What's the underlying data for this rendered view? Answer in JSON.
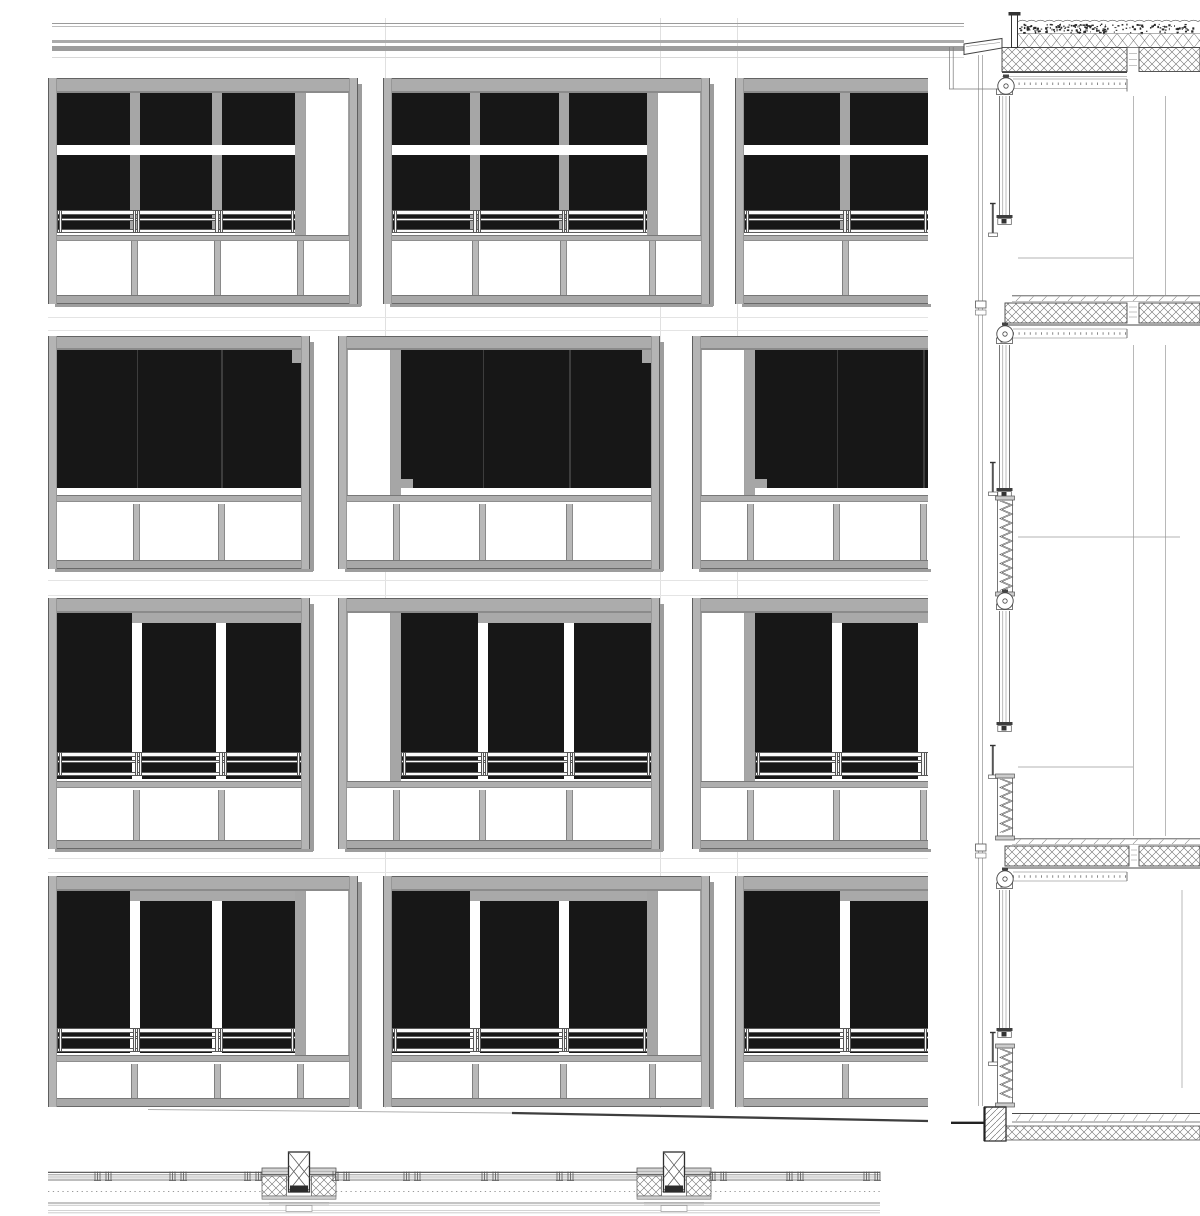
{
  "drawing": {
    "panels": {
      "elevation": "facade-elevation",
      "section": "vertical-wall-section",
      "plan": "horizontal-plan-strip"
    }
  },
  "colors": {
    "dark_glass": "#171717",
    "frame": "#acacac",
    "frame_edge": "#636363",
    "frame_light": "#b4b4b4",
    "mullion": "#a6a6a6",
    "lower_mullion": "#b8b8b8",
    "shadow": "#9d9d9d",
    "line": "#444444",
    "line_mid": "#777777",
    "line_faint": "#e0e0e0",
    "white": "#ffffff"
  },
  "facade": {
    "left": 48,
    "right": 928,
    "frame_w": 9,
    "glass_mullion_w": 10,
    "lower_mullion_w": 7,
    "side_pane_w": 44,
    "side_mullion_w": 10,
    "roof_lines": [
      {
        "y": 22.5,
        "h": 1.4,
        "color": "#9a9a9a"
      },
      {
        "y": 25.6,
        "h": 1.4,
        "color": "#bcbcbc"
      },
      {
        "y": 40.0,
        "h": 2.6,
        "color": "#ababab"
      },
      {
        "y": 45.5,
        "h": 5.5,
        "color": "#9d9d9d"
      },
      {
        "y": 57.0,
        "h": 1.0,
        "color": "#d8d8d8"
      }
    ],
    "grid_line_xs": [
      385,
      660,
      737
    ],
    "floor_faint_ys": [
      317,
      330,
      580,
      595,
      858,
      872
    ],
    "ground_slope": {
      "x1": 148,
      "y1": 1109.5,
      "xm": 512,
      "ym": 1113,
      "x2": 928,
      "y2": 1121
    },
    "rows": [
      {
        "name": "row-1",
        "style": "mullioned",
        "y": 78,
        "top_h": 15,
        "glass_top": 93,
        "dark_bottom": 232,
        "transom": {
          "y": 145,
          "h": 10
        },
        "railing": {
          "y": 210,
          "h": 23
        },
        "sill": {
          "bar_y": 234.5,
          "bar_h": 6.5
        },
        "lower_top": 241,
        "lower_bottom": 295,
        "bottom_y": 295,
        "bottom_h": 9,
        "units": [
          {
            "x": 48,
            "w": 310,
            "side": "right"
          },
          {
            "x": 383,
            "w": 327,
            "side": "right"
          },
          {
            "x": 735,
            "w": 327,
            "cut": true
          }
        ]
      },
      {
        "name": "row-2",
        "style": "blinds-full",
        "y": 336,
        "top_h": 14,
        "glass_top": 350,
        "dark_bottom": 488,
        "sill": {
          "bar_y": 494.5,
          "bar_h": 7.5
        },
        "lower_top": 504,
        "lower_bottom": 560,
        "bottom_y": 560,
        "bottom_h": 9,
        "units": [
          {
            "x": 48,
            "w": 262,
            "notches": [
              "tr"
            ]
          },
          {
            "x": 338,
            "w": 322,
            "side": "left",
            "notches": [
              "tr",
              "bl"
            ]
          },
          {
            "x": 692,
            "w": 322,
            "side": "left",
            "cut": true,
            "notches": [
              "bl"
            ]
          }
        ]
      },
      {
        "name": "row-3",
        "style": "blinds-panes",
        "y": 598,
        "top_h": 15,
        "glass_top": 613,
        "dark_bottom": 779,
        "sliver_h": 10,
        "railing": {
          "y": 752,
          "h": 24
        },
        "sill": {
          "bar_y": 781,
          "bar_h": 7
        },
        "lower_top": 790,
        "lower_bottom": 840,
        "bottom_y": 840,
        "bottom_h": 9,
        "units": [
          {
            "x": 48,
            "w": 262
          },
          {
            "x": 338,
            "w": 322,
            "side": "left"
          },
          {
            "x": 692,
            "w": 322,
            "side": "left",
            "cut": true
          }
        ]
      },
      {
        "name": "row-4",
        "style": "blinds-panes",
        "y": 876,
        "top_h": 15,
        "glass_top": 891,
        "dark_bottom": 1053,
        "sliver_h": 10,
        "railing": {
          "y": 1028,
          "h": 24
        },
        "sill": {
          "bar_y": 1055,
          "bar_h": 7
        },
        "lower_top": 1064,
        "lower_bottom": 1098,
        "bottom_y": 1098,
        "bottom_h": 9,
        "units": [
          {
            "x": 48,
            "w": 310,
            "side": "right"
          },
          {
            "x": 383,
            "w": 327,
            "side": "right"
          },
          {
            "x": 735,
            "w": 327,
            "cut": true
          }
        ]
      }
    ]
  },
  "section": {
    "cladding_xs": [
      978.5,
      982.5
    ],
    "frame_xs": [
      999.6,
      1002.8,
      1006,
      1009.5
    ],
    "top": 55,
    "bottom": 1106,
    "roof": {
      "wave_y": 21.5,
      "veg_band": [
        23,
        33
      ],
      "insul_band": [
        33.5,
        47.5
      ],
      "slab": {
        "y1": 47.5,
        "y2": 71.5,
        "x1": 1002,
        "joint": [
          1127,
          1139
        ]
      },
      "ceil_y": 72.5,
      "box_band": [
        79,
        88.5
      ],
      "parapet": {
        "coping": [
          [
            964,
            44
          ],
          [
            1002,
            38.5
          ],
          [
            1002,
            48
          ],
          [
            964,
            54.5
          ]
        ],
        "post": [
          1011.5,
          13.5,
          6,
          34
        ],
        "cap": [
          1008.5,
          12,
          12,
          3.5
        ],
        "bracket_xs": [
          949.5,
          953.2
        ],
        "bracket_y": [
          47,
          89
        ]
      }
    },
    "floors": [
      {
        "y": 295,
        "joint": [
          1127,
          1139
        ]
      },
      {
        "y": 838,
        "joint": [
          1129,
          1139
        ]
      }
    ],
    "ground": {
      "screed_y": 1113,
      "hatch_y": 1126,
      "hatch_h": 14,
      "plinth": [
        984.5,
        1107,
        21.5,
        34
      ],
      "ground_line": {
        "x1": 951,
        "x2": 984.5,
        "y": 1122.8
      }
    },
    "rollers": [
      {
        "cx": 1006,
        "cy": 86
      },
      {
        "cx": 1005,
        "cy": 334
      },
      {
        "cx": 1005,
        "cy": 601
      },
      {
        "cx": 1005,
        "cy": 879
      }
    ],
    "windows": [
      {
        "y1": 96,
        "y2": 215
      },
      {
        "y1": 345,
        "y2": 488
      },
      {
        "y1": 611,
        "y2": 722
      },
      {
        "y1": 890,
        "y2": 1028
      }
    ],
    "pins": [
      {
        "y": 203
      },
      {
        "y": 462
      },
      {
        "y": 745
      },
      {
        "y": 1032
      }
    ],
    "spandrels": [
      {
        "y1": 500,
        "y2": 592
      },
      {
        "y1": 778,
        "y2": 836
      },
      {
        "y1": 1048,
        "y2": 1103
      }
    ],
    "interior_v": [
      {
        "x": 1133.5,
        "y1": 96,
        "y2": 295
      },
      {
        "x": 1165.5,
        "y1": 96,
        "y2": 295
      },
      {
        "x": 1133.5,
        "y1": 345,
        "y2": 836
      },
      {
        "x": 1165.5,
        "y1": 345,
        "y2": 836
      },
      {
        "x": 1182,
        "y1": 890,
        "y2": 1088
      }
    ],
    "interior_h": [
      {
        "y": 258,
        "x1": 1018,
        "x2": 1133
      },
      {
        "y": 537,
        "x1": 1018,
        "x2": 1180
      },
      {
        "y": 767,
        "x1": 1018,
        "x2": 1133
      }
    ]
  },
  "plan": {
    "x1": 48,
    "x2": 880,
    "lines": [
      {
        "y": 1172.3,
        "w": 1.1,
        "c": "#4a4a4a"
      },
      {
        "y": 1174.8,
        "w": 0.8,
        "c": "#8a8a8a"
      },
      {
        "y": 1177.0,
        "w": 0.7,
        "c": "#9a9a9a"
      },
      {
        "y": 1179.8,
        "w": 2.4,
        "c": "#bdbdbd"
      },
      {
        "y": 1203.0,
        "w": 1.0,
        "c": "#8a8a8a"
      },
      {
        "y": 1205.2,
        "w": 0.7,
        "c": "#ababab"
      },
      {
        "y": 1210.6,
        "w": 0.8,
        "c": "#c6c6c6"
      },
      {
        "y": 1212.8,
        "w": 0.8,
        "c": "#c6c6c6"
      }
    ],
    "dotted_y": 1191.5,
    "clip_xs": [
      103,
      178,
      253,
      341,
      412,
      490,
      565,
      718,
      795,
      872
    ],
    "column_cxs": [
      299,
      674
    ]
  }
}
